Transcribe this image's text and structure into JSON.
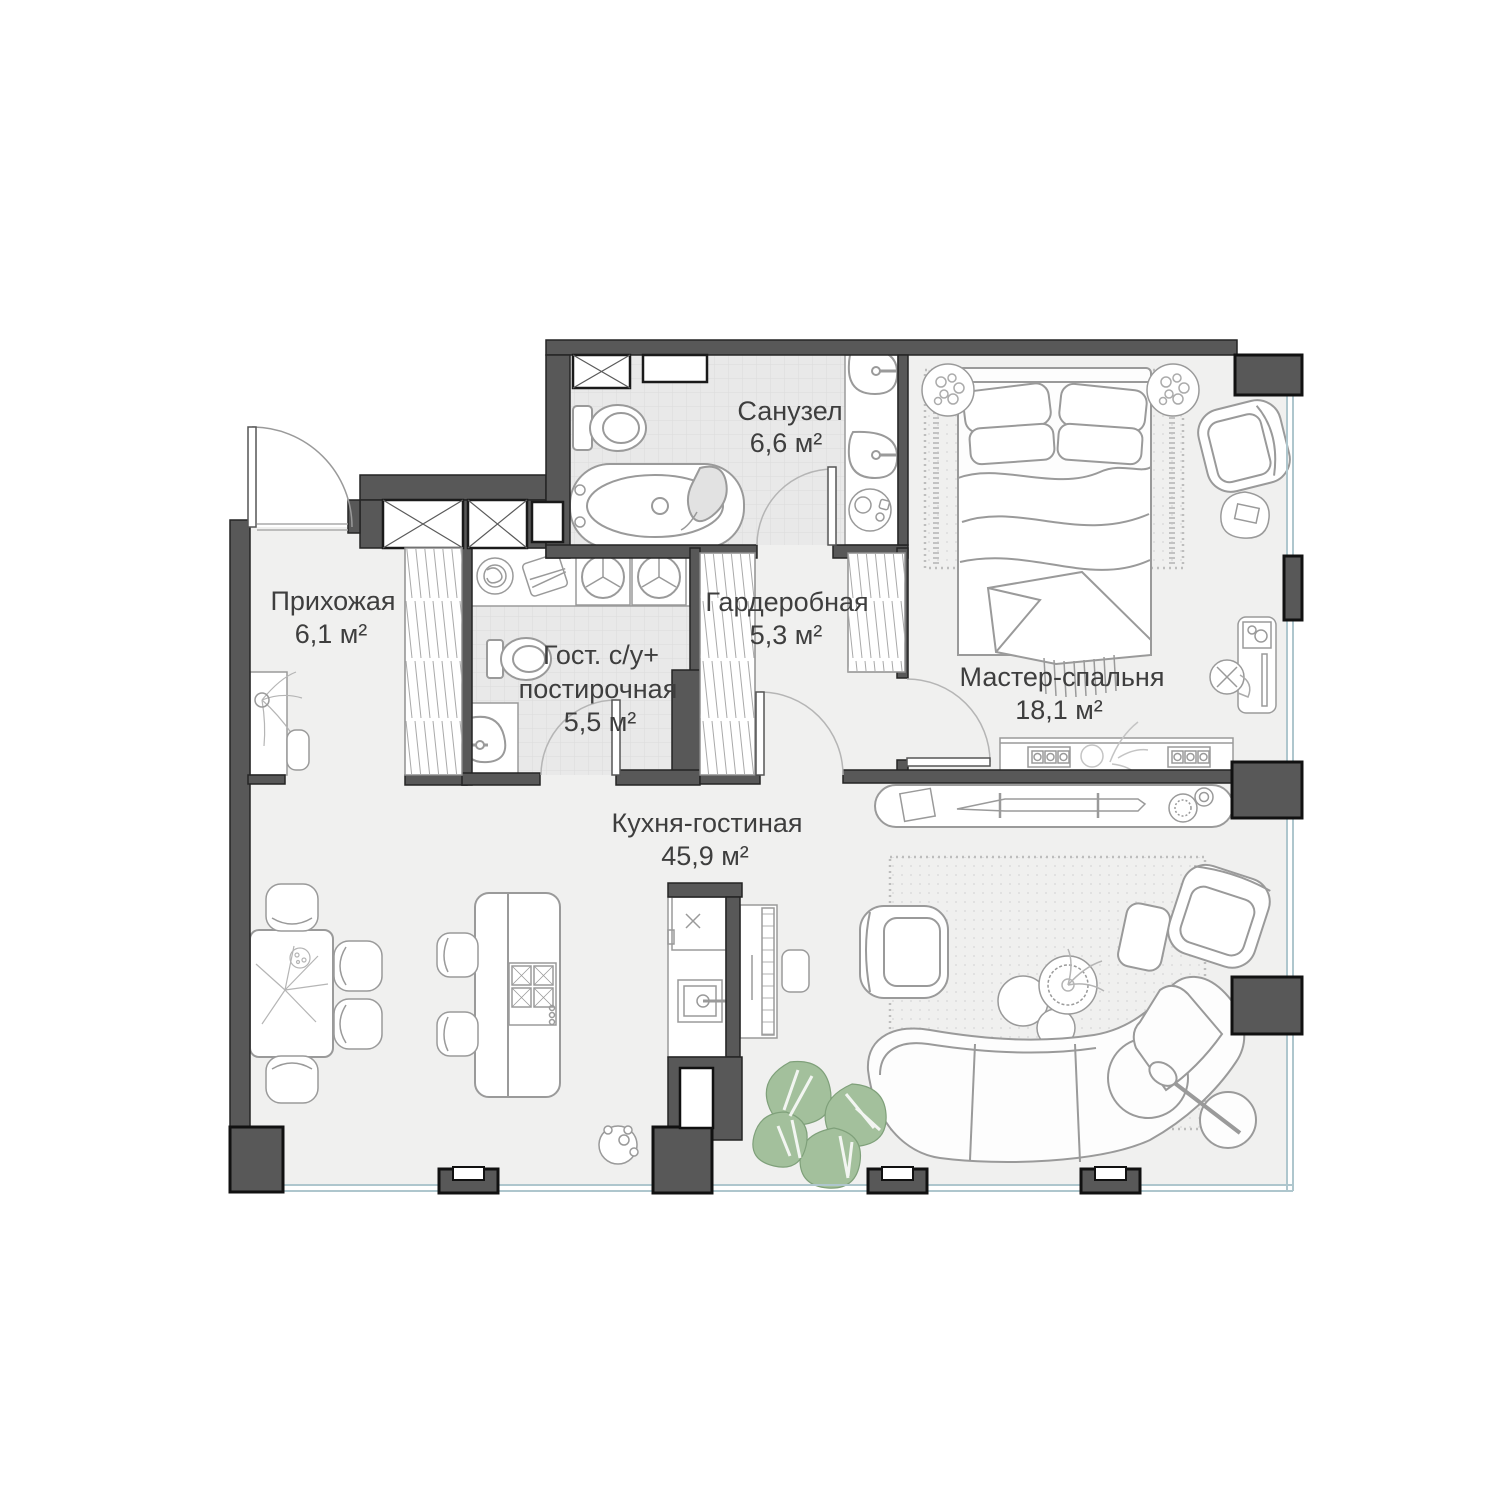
{
  "title": "Apartment floor plan",
  "colors": {
    "wall": "#585858",
    "wall_edge": "#1e1e1e",
    "floor": "#f0f0ef",
    "tile": "#e9e9e9",
    "outline": "#9a9a9a",
    "plant": "#a3c09c",
    "glass": "#aec6cd",
    "text": "#3e3e3e"
  },
  "rooms": [
    {
      "id": "sanuzel",
      "name": "Санузел",
      "area": "6,6 м²"
    },
    {
      "id": "prihozhaya",
      "name": "Прихожая",
      "area": "6,1 м²"
    },
    {
      "id": "garderobnaya",
      "name": "Гардеробная",
      "area": "5,3 м²"
    },
    {
      "id": "guest-wc",
      "name_line1": "Гост. с/у+",
      "name_line2": "постирочная",
      "area": "5,5 м²"
    },
    {
      "id": "master",
      "name": "Мастер-спальня",
      "area": "18,1 м²"
    },
    {
      "id": "kitchen",
      "name": "Кухня-гостиная",
      "area": "45,9 м²"
    }
  ]
}
